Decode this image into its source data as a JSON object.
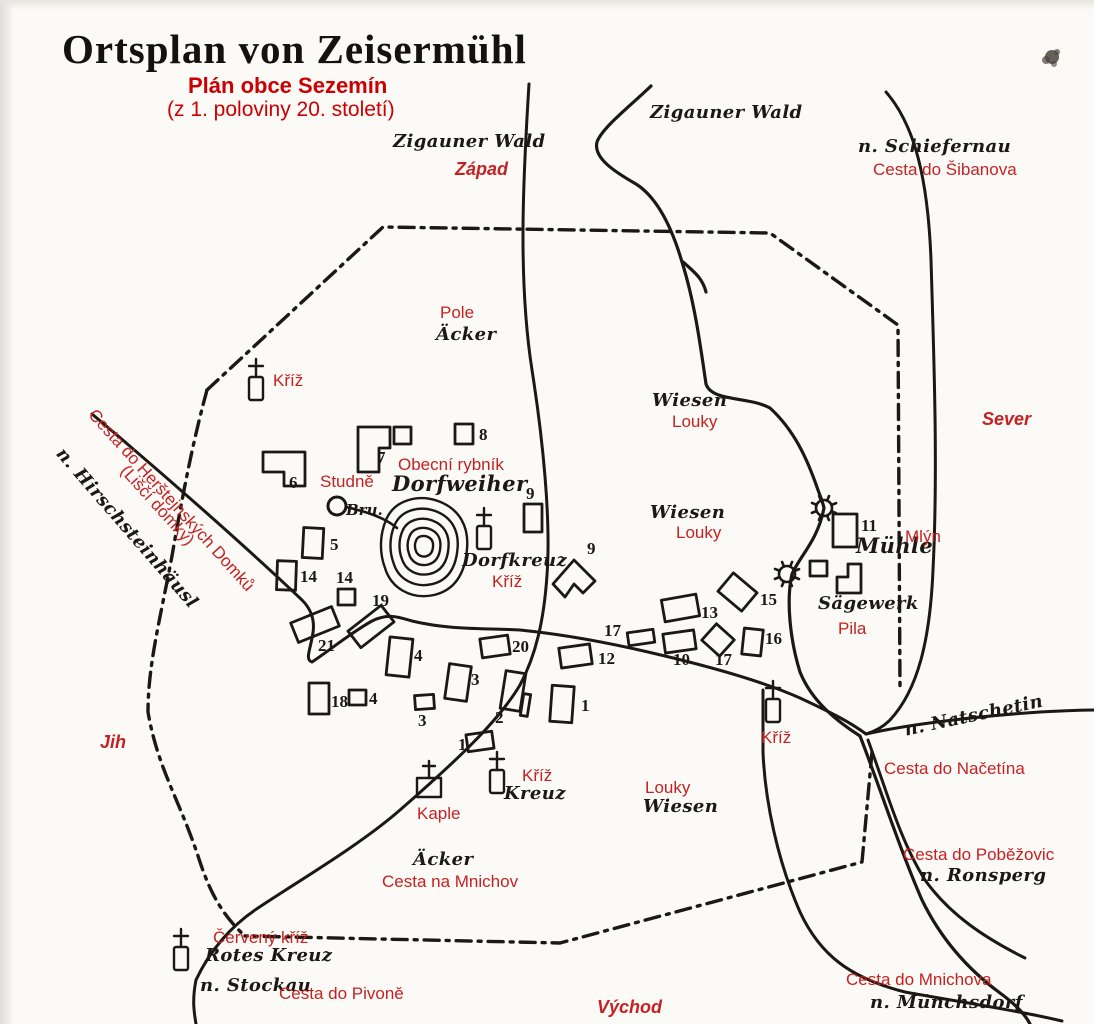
{
  "page": {
    "bg": "#fbfaf7",
    "ink": "#1c1813",
    "red": "#c42222",
    "title_red": "#cc0000",
    "width": 1094,
    "height": 1024
  },
  "title": {
    "de": "Ortsplan von Zeisermühl",
    "cz": "Plán obce Sezemín",
    "note": "(z 1. poloviny 20. století)"
  },
  "labels": [
    {
      "name": "label-zigauner-wald-west",
      "text": "Zigauner Wald",
      "x": 393,
      "y": 133,
      "cls": "de"
    },
    {
      "name": "label-zapad",
      "text": "Západ",
      "x": 455,
      "y": 160,
      "cls": "dir"
    },
    {
      "name": "label-zigauner-wald-north",
      "text": "Zigauner Wald",
      "x": 650,
      "y": 104,
      "cls": "de"
    },
    {
      "name": "label-n-schiefernau",
      "text": "n. Schiefernau",
      "x": 858,
      "y": 138,
      "cls": "de"
    },
    {
      "name": "label-cesta-do-sibanova",
      "text": "Cesta do Šibanova",
      "x": 873,
      "y": 161,
      "cls": "cz"
    },
    {
      "name": "label-sever",
      "text": "Sever",
      "x": 982,
      "y": 410,
      "cls": "dir"
    },
    {
      "name": "label-pole",
      "text": "Pole",
      "x": 440,
      "y": 304,
      "cls": "cz"
    },
    {
      "name": "label-acker-north",
      "text": "Äcker",
      "x": 436,
      "y": 326,
      "cls": "de"
    },
    {
      "name": "label-kriz-nw",
      "text": "Kříž",
      "x": 273,
      "y": 372,
      "cls": "cz"
    },
    {
      "name": "label-wiesen-upper",
      "text": "Wiesen",
      "x": 652,
      "y": 392,
      "cls": "de"
    },
    {
      "name": "label-louky-upper",
      "text": "Louky",
      "x": 672,
      "y": 413,
      "cls": "cz"
    },
    {
      "name": "label-wiesen-mid",
      "text": "Wiesen",
      "x": 650,
      "y": 504,
      "cls": "de"
    },
    {
      "name": "label-louky-mid",
      "text": "Louky",
      "x": 676,
      "y": 524,
      "cls": "cz"
    },
    {
      "name": "label-obecni-rybnik",
      "text": "Obecní rybník",
      "x": 398,
      "y": 456,
      "cls": "cz"
    },
    {
      "name": "label-dorfweiher",
      "text": "Dorfweiher",
      "x": 392,
      "y": 473,
      "cls": "de-lg"
    },
    {
      "name": "label-studne",
      "text": "Studně",
      "x": 320,
      "y": 473,
      "cls": "cz"
    },
    {
      "name": "label-bru",
      "text": "Bru.",
      "x": 346,
      "y": 503,
      "cls": "de-sm"
    },
    {
      "name": "label-dorfkreuz",
      "text": "Dorfkreuz",
      "x": 462,
      "y": 552,
      "cls": "de"
    },
    {
      "name": "label-kriz-dorfkreuz",
      "text": "Kříž",
      "x": 492,
      "y": 573,
      "cls": "cz"
    },
    {
      "name": "label-muhle",
      "text": "Mühle",
      "x": 856,
      "y": 535,
      "cls": "de-lg"
    },
    {
      "name": "label-mlyn",
      "text": "Mlýn",
      "x": 905,
      "y": 528,
      "cls": "cz"
    },
    {
      "name": "label-sagewerk",
      "text": "Sägewerk",
      "x": 818,
      "y": 595,
      "cls": "de"
    },
    {
      "name": "label-pila",
      "text": "Pila",
      "x": 838,
      "y": 620,
      "cls": "cz"
    },
    {
      "name": "label-kriz-east",
      "text": "Kříž",
      "x": 761,
      "y": 729,
      "cls": "cz"
    },
    {
      "name": "label-n-natschetin",
      "text": "n. Natschetin",
      "x": 903,
      "y": 722,
      "cls": "de",
      "rot": -12
    },
    {
      "name": "label-cesta-do-nacetina",
      "text": "Cesta do Načetína",
      "x": 884,
      "y": 760,
      "cls": "cz"
    },
    {
      "name": "label-cesta-do-pobezovic",
      "text": "Cesta do Poběžovic",
      "x": 903,
      "y": 846,
      "cls": "cz"
    },
    {
      "name": "label-n-ronsperg",
      "text": "n. Ronsperg",
      "x": 920,
      "y": 867,
      "cls": "de"
    },
    {
      "name": "label-jih",
      "text": "Jih",
      "x": 100,
      "y": 733,
      "cls": "dir"
    },
    {
      "name": "label-kaple",
      "text": "Kaple",
      "x": 417,
      "y": 805,
      "cls": "cz"
    },
    {
      "name": "label-kriz-kreuz",
      "text": "Kříž",
      "x": 522,
      "y": 767,
      "cls": "cz"
    },
    {
      "name": "label-kreuz",
      "text": "Kreuz",
      "x": 504,
      "y": 785,
      "cls": "de"
    },
    {
      "name": "label-louky-south",
      "text": "Louky",
      "x": 645,
      "y": 779,
      "cls": "cz"
    },
    {
      "name": "label-wiesen-south",
      "text": "Wiesen",
      "x": 643,
      "y": 798,
      "cls": "de"
    },
    {
      "name": "label-acker-south",
      "text": "Äcker",
      "x": 413,
      "y": 851,
      "cls": "de"
    },
    {
      "name": "label-cesta-na-mnichov",
      "text": "Cesta na Mnichov",
      "x": 382,
      "y": 873,
      "cls": "cz"
    },
    {
      "name": "label-cerveny-kriz",
      "text": "Červený kříž",
      "x": 213,
      "y": 929,
      "cls": "cz"
    },
    {
      "name": "label-rotes-kreuz",
      "text": "Rotes Kreuz",
      "x": 205,
      "y": 947,
      "cls": "de"
    },
    {
      "name": "label-n-stockau",
      "text": "n. Stockau",
      "x": 200,
      "y": 977,
      "cls": "de"
    },
    {
      "name": "label-cesta-do-pivone",
      "text": "Cesta do Pivoně",
      "x": 279,
      "y": 985,
      "cls": "cz"
    },
    {
      "name": "label-vychod",
      "text": "Východ",
      "x": 597,
      "y": 998,
      "cls": "dir"
    },
    {
      "name": "label-cesta-do-mnichova",
      "text": "Cesta do Mnichova",
      "x": 846,
      "y": 971,
      "cls": "cz"
    },
    {
      "name": "label-n-munchsdorf",
      "text": "n. Münchsdorf",
      "x": 870,
      "y": 994,
      "cls": "de"
    },
    {
      "name": "label-cesta-herstejnskych",
      "text": "Cesta do Herštejnských Domků",
      "x": 98,
      "y": 406,
      "cls": "cz",
      "rot": 48
    },
    {
      "name": "label-lisci-domky",
      "text": "(Liščí domky)",
      "x": 130,
      "y": 462,
      "cls": "cz",
      "rot": 48
    },
    {
      "name": "label-n-hirschsteinhausl",
      "text": "n. Hirschsteinhäusl",
      "x": 66,
      "y": 445,
      "cls": "de",
      "rot": 49
    }
  ],
  "buildings": [
    {
      "num": "8",
      "x": 455,
      "y": 424,
      "w": 18,
      "h": 20,
      "lx": 479,
      "ly": 440
    },
    {
      "num": "",
      "x": 394,
      "y": 427,
      "w": 17,
      "h": 17
    },
    {
      "num": "9",
      "x": 524,
      "y": 504,
      "w": 18,
      "h": 28,
      "lx": 526,
      "ly": 499
    },
    {
      "num": "5",
      "x": 303,
      "y": 528,
      "w": 20,
      "h": 30,
      "rot": 3,
      "lx": 330,
      "ly": 550
    },
    {
      "num": "14",
      "x": 277,
      "y": 561,
      "w": 19,
      "h": 29,
      "rot": 2,
      "lx": 300,
      "ly": 582
    },
    {
      "num": "14",
      "x": 338,
      "y": 589,
      "w": 17,
      "h": 16,
      "lx": 336,
      "ly": 583
    },
    {
      "num": "19",
      "x": 350,
      "y": 616,
      "w": 42,
      "h": 21,
      "rot": -38,
      "lx": 372,
      "ly": 606
    },
    {
      "num": "21",
      "x": 293,
      "y": 614,
      "w": 44,
      "h": 21,
      "rot": -22,
      "lx": 318,
      "ly": 651
    },
    {
      "num": "4",
      "x": 388,
      "y": 638,
      "w": 23,
      "h": 38,
      "rot": 6,
      "lx": 414,
      "ly": 661
    },
    {
      "num": "20",
      "x": 481,
      "y": 637,
      "w": 28,
      "h": 19,
      "rot": -8,
      "lx": 512,
      "ly": 652
    },
    {
      "num": "12",
      "x": 560,
      "y": 646,
      "w": 31,
      "h": 20,
      "rot": -8,
      "lx": 598,
      "ly": 664
    },
    {
      "num": "17",
      "x": 628,
      "y": 631,
      "w": 26,
      "h": 13,
      "rot": -8,
      "lx": 604,
      "ly": 636
    },
    {
      "num": "10",
      "x": 664,
      "y": 632,
      "w": 31,
      "h": 19,
      "rot": -8,
      "lx": 673,
      "ly": 665
    },
    {
      "num": "17",
      "x": 706,
      "y": 629,
      "w": 24,
      "h": 22,
      "rot": 42,
      "lx": 715,
      "ly": 665
    },
    {
      "num": "16",
      "x": 743,
      "y": 629,
      "w": 19,
      "h": 26,
      "rot": 6,
      "lx": 765,
      "ly": 644
    },
    {
      "num": "13",
      "x": 663,
      "y": 597,
      "w": 35,
      "h": 22,
      "rot": -10,
      "lx": 701,
      "ly": 618
    },
    {
      "num": "15",
      "x": 722,
      "y": 580,
      "w": 31,
      "h": 24,
      "rot": 40,
      "lx": 760,
      "ly": 605
    },
    {
      "num": "3",
      "x": 447,
      "y": 665,
      "w": 22,
      "h": 35,
      "rot": 8,
      "lx": 471,
      "ly": 685
    },
    {
      "num": "18",
      "x": 309,
      "y": 683,
      "w": 20,
      "h": 31,
      "lx": 331,
      "ly": 707
    },
    {
      "num": "4",
      "x": 349,
      "y": 690,
      "w": 17,
      "h": 15,
      "lx": 369,
      "ly": 704
    },
    {
      "num": "3",
      "x": 415,
      "y": 695,
      "w": 19,
      "h": 14,
      "rot": -4,
      "lx": 418,
      "ly": 726
    },
    {
      "num": "2",
      "x": 503,
      "y": 672,
      "w": 20,
      "h": 38,
      "rot": 9,
      "lx": 495,
      "ly": 723
    },
    {
      "num": "",
      "x": 522,
      "y": 694,
      "w": 7,
      "h": 22,
      "rot": 9
    },
    {
      "num": "1",
      "x": 551,
      "y": 686,
      "w": 22,
      "h": 36,
      "rot": 4,
      "lx": 581,
      "ly": 711
    },
    {
      "num": "1",
      "x": 467,
      "y": 733,
      "w": 26,
      "h": 17,
      "rot": -8,
      "lx": 458,
      "ly": 750
    },
    {
      "num": "11",
      "x": 833,
      "y": 514,
      "w": 24,
      "h": 33,
      "lx": 861,
      "ly": 531
    },
    {
      "num": "",
      "x": 810,
      "y": 561,
      "w": 17,
      "h": 15
    }
  ],
  "building_polygons": [
    {
      "num": "6",
      "pts": "263,452 305,452 305,486 284,486 284,472 263,472",
      "lx": 289,
      "ly": 488
    },
    {
      "num": "7",
      "pts": "358,427 390,427 390,448 379,448 379,472 358,472",
      "lx": 377,
      "ly": 463
    },
    {
      "num": "9",
      "pts": "553,584 574,560 595,581 583,593 574,584 565,597",
      "lx": 587,
      "ly": 554
    },
    {
      "num": "",
      "pts": "837,593 837,577 848,577 848,564 861,564 861,593"
    }
  ],
  "symbols": [
    {
      "type": "cross",
      "name": "wayside-cross-nw",
      "x": 256,
      "y": 400
    },
    {
      "type": "cross",
      "name": "dorfkreuz-cross",
      "x": 484,
      "y": 549
    },
    {
      "type": "cross",
      "name": "kreuz-cross",
      "x": 497,
      "y": 793
    },
    {
      "type": "cross",
      "name": "wayside-cross-east",
      "x": 773,
      "y": 722
    },
    {
      "type": "cross",
      "name": "rotes-kreuz-cross",
      "x": 181,
      "y": 970
    },
    {
      "type": "chapel",
      "name": "chapel",
      "x": 429,
      "y": 797
    },
    {
      "type": "well",
      "name": "village-well",
      "x": 337,
      "y": 506,
      "r": 9
    },
    {
      "type": "wheel",
      "name": "mill-waterwheel",
      "x": 824,
      "y": 508
    },
    {
      "type": "wheel",
      "name": "sawmill-waterwheel",
      "x": 787,
      "y": 574
    },
    {
      "type": "blob",
      "name": "ink-blot",
      "x": 1052,
      "y": 57
    }
  ]
}
